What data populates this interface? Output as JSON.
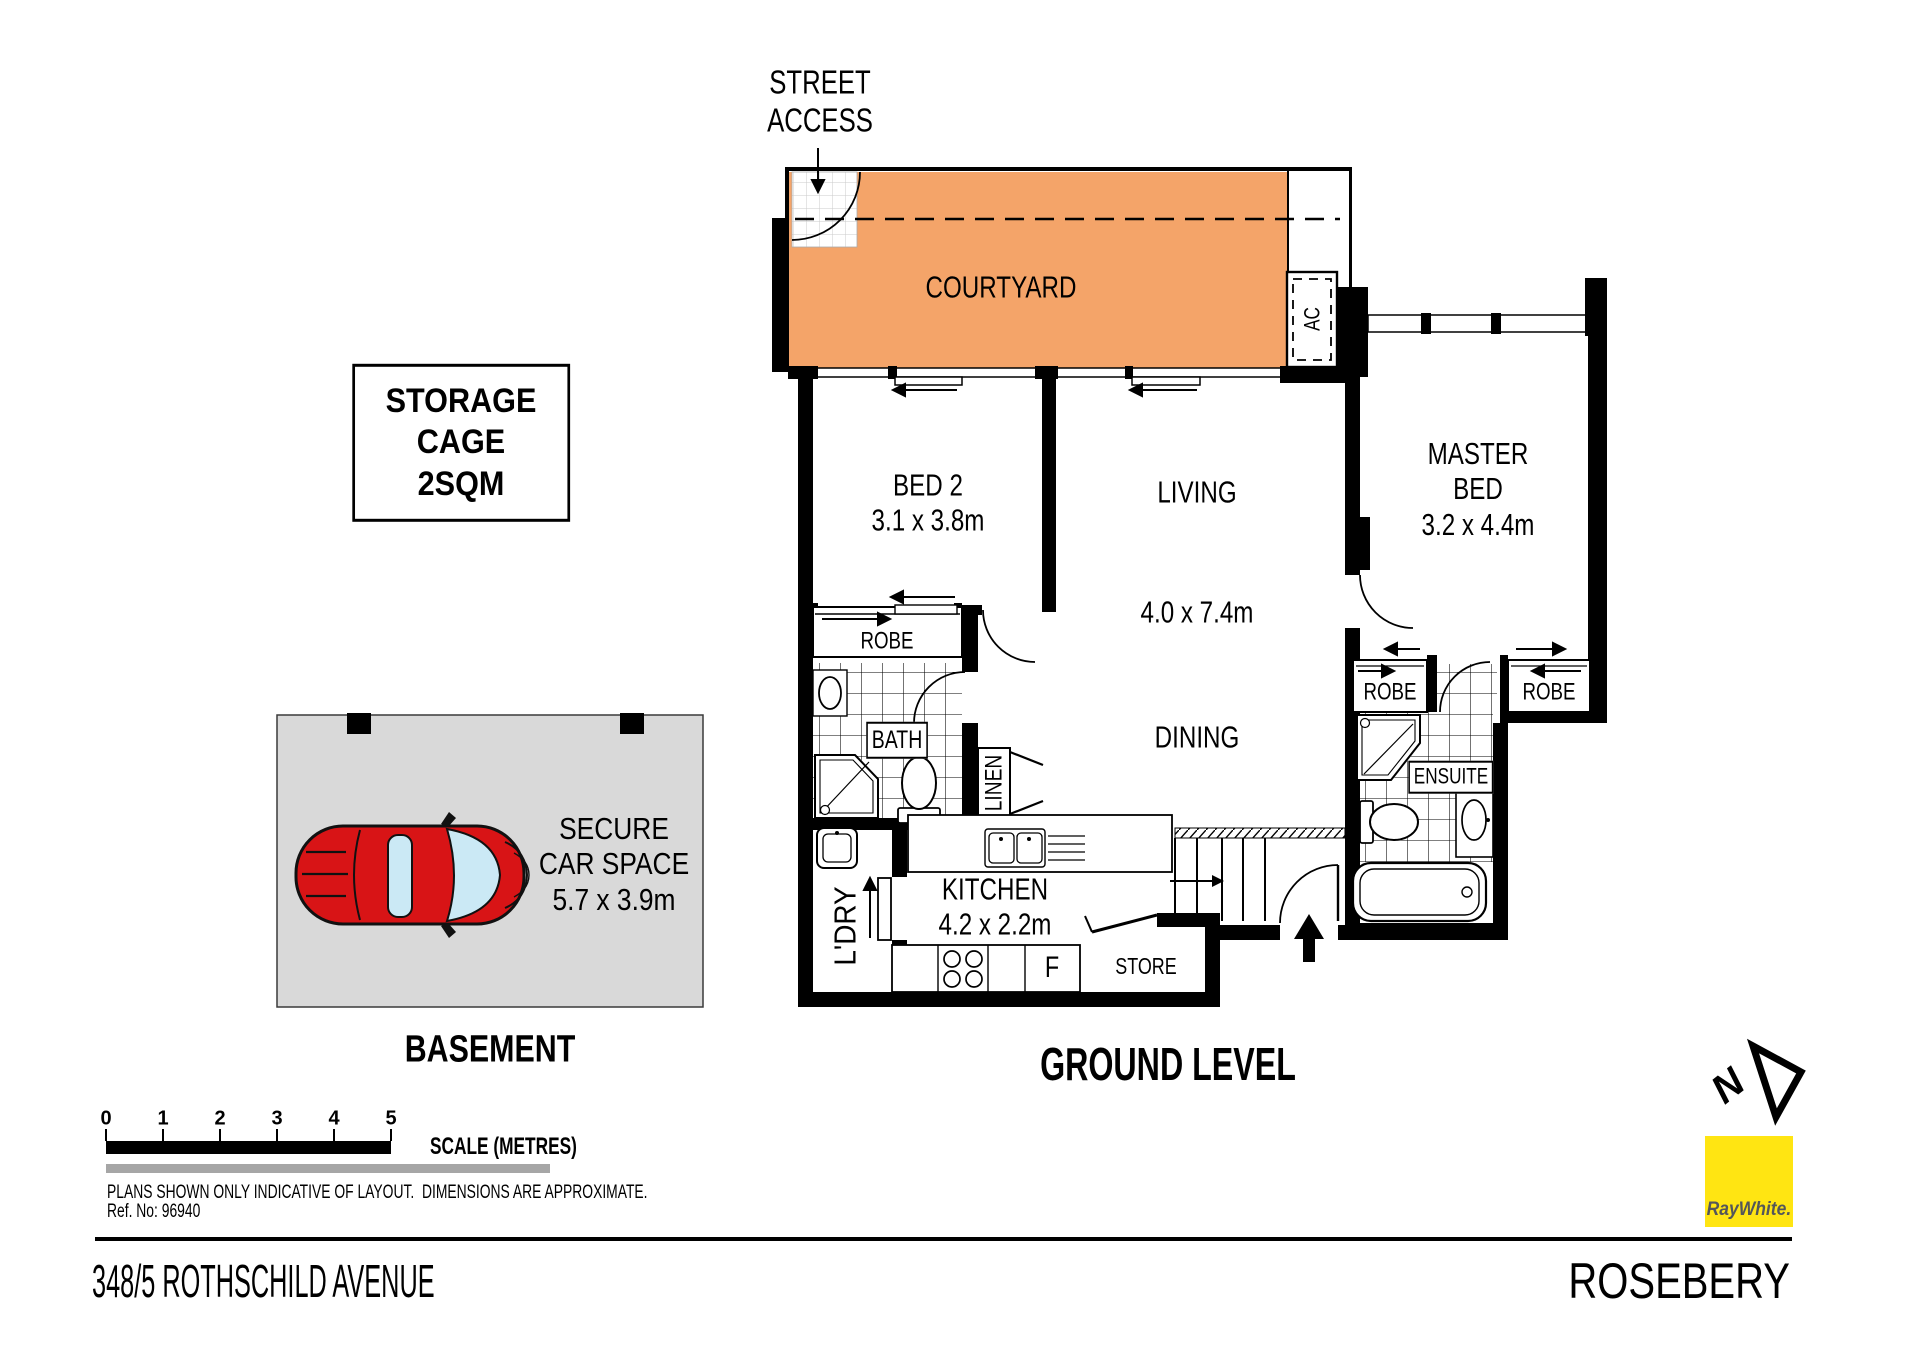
{
  "plan": {
    "street_access": "STREET\nACCESS",
    "courtyard": "COURTYARD",
    "ac": "AC",
    "bed2": "BED 2\n3.1 x 3.8m",
    "living": "LIVING",
    "living_dims": "4.0 x 7.4m",
    "dining": "DINING",
    "master_bed": "MASTER\nBED\n3.2 x 4.4m",
    "robe": "ROBE",
    "bath": "BATH",
    "ensuite": "ENSUITE",
    "linen": "LINEN",
    "laundry": "L'DRY",
    "kitchen": "KITCHEN\n4.2 x 2.2m",
    "fridge": "F",
    "store": "STORE",
    "ground_label": "GROUND LEVEL"
  },
  "basement": {
    "storage_cage": "STORAGE\nCAGE\n2SQM",
    "car_space": "SECURE\nCAR SPACE\n5.7 x 3.9m",
    "label": "BASEMENT"
  },
  "scale_bar": {
    "ticks": [
      "0",
      "1",
      "2",
      "3",
      "4",
      "5"
    ],
    "label": "SCALE (METRES)"
  },
  "footer": {
    "disclaimer": "PLANS SHOWN ONLY INDICATIVE OF LAYOUT.  DIMENSIONS ARE APPROXIMATE.",
    "ref_no": "Ref. No: 96940",
    "address": "348/5 ROTHSCHILD AVENUE",
    "suburb": "ROSEBERY",
    "brand": "RayWhite."
  },
  "colors": {
    "courtyard": "#F4A469",
    "carpark": "#D9D9D9",
    "car": "#D81416",
    "glass": "#CBE9F5",
    "brand_yellow": "#FFE512",
    "brand_text": "#54565A",
    "scale_gray": "#A6A6A6"
  }
}
